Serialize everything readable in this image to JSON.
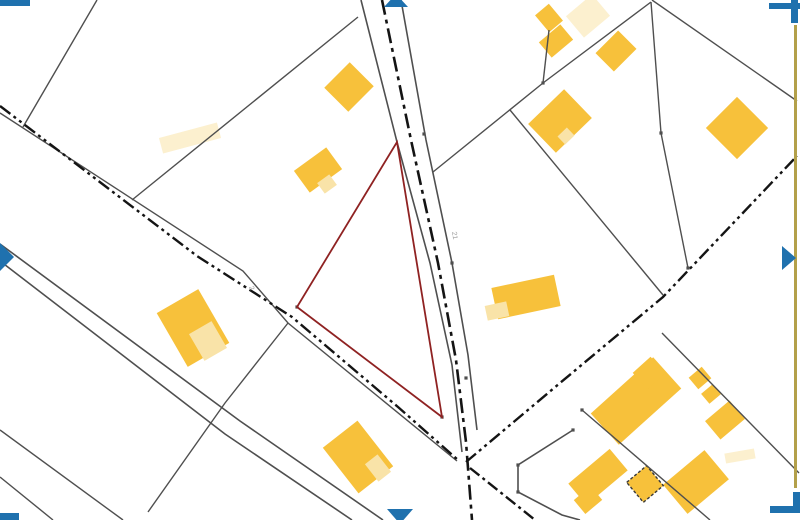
{
  "map": {
    "width": 800,
    "height": 520,
    "background": "#ffffff",
    "colors": {
      "building_solid": "#F7C13B",
      "building_light": "#F9E3A8",
      "building_ghost": "#FCF0CF",
      "parcel_line": "#4f4f4f",
      "road_axis": "#141414",
      "highlight": "#8f2222",
      "frame_blue": "#1f71ae",
      "sheet_edge": "#b3a04a",
      "label_gray": "#999999"
    },
    "sheet_edge_line": {
      "x": 795.5,
      "y1": 25,
      "y2": 488,
      "width": 3
    },
    "frame_corners": [
      {
        "name": "top-left-bracket",
        "rects": [
          [
            0,
            0,
            30,
            6
          ]
        ]
      },
      {
        "name": "top-right-bracket",
        "rects": [
          [
            769,
            3,
            31,
            6
          ],
          [
            791,
            0,
            7,
            23
          ]
        ]
      },
      {
        "name": "bottom-right-bracket",
        "rects": [
          [
            770,
            506,
            30,
            7
          ],
          [
            793,
            492,
            7,
            21
          ]
        ]
      },
      {
        "name": "bottom-left-bracket",
        "rects": [
          [
            0,
            513,
            19,
            7
          ]
        ]
      }
    ],
    "frame_triangles": [
      {
        "name": "left-edge-mark",
        "points": "0,243 14,257 0,271"
      },
      {
        "name": "right-edge-mark",
        "points": "782,246 796,258 782,270"
      },
      {
        "name": "top-edge-mark",
        "points": "384,7 408,7 396,-6"
      },
      {
        "name": "bottom-edge-mark",
        "points": "387,509 413,509 400,524"
      }
    ],
    "road_edges": [
      {
        "points": "361,0 397,142 430,263 452,365 462,452"
      },
      {
        "points": "401,0 426,140 452,263 468,355 477,430"
      },
      {
        "points": "0,244 240,421 383,520"
      },
      {
        "points": "0,261 225,434 352,520"
      },
      {
        "points": "573,430 518,465 518,492 562,515 580,520"
      }
    ],
    "road_axes": [
      {
        "points": "382,0 411,140 438,263 456,360 466,442 468,468 472,520",
        "width": 2.6,
        "dash": "15 5 4 5"
      },
      {
        "points": "0,106 197,256 292,317 398,407 458,460",
        "width": 2.4,
        "dash": "13 4 3 4 3 4"
      },
      {
        "points": "466,462 560,383 663,297 797,156",
        "width": 2.4,
        "dash": "13 4 3 4 3 4"
      },
      {
        "points": "470,468 535,520",
        "width": 2.4,
        "dash": "12 4 3 4"
      }
    ],
    "parcel_lines": [
      {
        "points": "97,0 23,127"
      },
      {
        "points": "358,17 132,200"
      },
      {
        "points": "0,113 243,271 288,323 457,461"
      },
      {
        "points": "288,323 225,403 148,512"
      },
      {
        "points": "0,430 123,520"
      },
      {
        "points": "0,477 53,520"
      },
      {
        "points": "651,2 543,83 433,172"
      },
      {
        "points": "651,2 661,133 688,268"
      },
      {
        "points": "652,0 797,101"
      },
      {
        "points": "549,30 543,83"
      },
      {
        "points": "510,110 663,295"
      },
      {
        "points": "662,333 799,473"
      },
      {
        "points": "582,410 710,520"
      }
    ],
    "highlight_parcel": {
      "points": "397,142 442,417 297,307",
      "width": 1.8
    },
    "buildings": [
      {
        "cx": 349,
        "cy": 87,
        "w": 36,
        "h": 34,
        "rot": -45,
        "type": "solid"
      },
      {
        "cx": 318,
        "cy": 170,
        "w": 40,
        "h": 27,
        "rot": -36,
        "type": "solid"
      },
      {
        "cx": 327,
        "cy": 184,
        "w": 15,
        "h": 13,
        "rot": -36,
        "type": "light"
      },
      {
        "cx": 549,
        "cy": 18,
        "w": 18,
        "h": 22,
        "rot": -40,
        "type": "solid"
      },
      {
        "cx": 556,
        "cy": 41,
        "w": 28,
        "h": 20,
        "rot": -40,
        "type": "solid"
      },
      {
        "cx": 588,
        "cy": 16,
        "w": 34,
        "h": 28,
        "rot": -40,
        "type": "ghost"
      },
      {
        "cx": 616,
        "cy": 51,
        "w": 32,
        "h": 26,
        "rot": -45,
        "type": "solid"
      },
      {
        "cx": 560,
        "cy": 121,
        "w": 50,
        "h": 40,
        "rot": -44,
        "type": "solid"
      },
      {
        "cx": 566,
        "cy": 136,
        "w": 13,
        "h": 11,
        "rot": -44,
        "type": "light"
      },
      {
        "cx": 737,
        "cy": 128,
        "w": 44,
        "h": 44,
        "rot": -45,
        "type": "solid"
      },
      {
        "cx": 526,
        "cy": 297,
        "w": 64,
        "h": 32,
        "rot": -12,
        "type": "solid"
      },
      {
        "cx": 497,
        "cy": 311,
        "w": 22,
        "h": 15,
        "rot": -12,
        "type": "light"
      },
      {
        "cx": 193,
        "cy": 328,
        "w": 48,
        "h": 62,
        "rot": -30,
        "type": "solid"
      },
      {
        "cx": 208,
        "cy": 341,
        "w": 26,
        "h": 31,
        "rot": -30,
        "type": "light"
      },
      {
        "cx": 358,
        "cy": 457,
        "w": 44,
        "h": 58,
        "rot": -38,
        "type": "solid"
      },
      {
        "cx": 378,
        "cy": 468,
        "w": 16,
        "h": 22,
        "rot": -38,
        "type": "light"
      },
      {
        "cx": 636,
        "cy": 401,
        "w": 84,
        "h": 42,
        "rot": -42,
        "type": "solid"
      },
      {
        "cx": 649,
        "cy": 373,
        "w": 24,
        "h": 22,
        "rot": -42,
        "type": "solid"
      },
      {
        "cx": 700,
        "cy": 378,
        "w": 17,
        "h": 15,
        "rot": -40,
        "type": "solid"
      },
      {
        "cx": 711,
        "cy": 394,
        "w": 15,
        "h": 13,
        "rot": -40,
        "type": "solid"
      },
      {
        "cx": 725,
        "cy": 420,
        "w": 32,
        "h": 24,
        "rot": -40,
        "type": "solid"
      },
      {
        "cx": 598,
        "cy": 477,
        "w": 54,
        "h": 28,
        "rot": -40,
        "type": "solid"
      },
      {
        "cx": 588,
        "cy": 500,
        "w": 22,
        "h": 18,
        "rot": -40,
        "type": "solid"
      },
      {
        "cx": 696,
        "cy": 482,
        "w": 54,
        "h": 38,
        "rot": -40,
        "type": "solid"
      },
      {
        "cx": 645,
        "cy": 484,
        "w": 26,
        "h": 26,
        "rot": -40,
        "type": "dashed"
      },
      {
        "cx": 190,
        "cy": 138,
        "w": 60,
        "h": 16,
        "rot": -15,
        "type": "ghost"
      },
      {
        "cx": 740,
        "cy": 456,
        "w": 30,
        "h": 10,
        "rot": -10,
        "type": "ghost"
      }
    ],
    "vertex_ticks": [
      [
        424,
        134
      ],
      [
        452,
        263
      ],
      [
        466,
        378
      ],
      [
        518,
        465
      ],
      [
        518,
        492
      ],
      [
        573,
        430
      ],
      [
        442,
        417
      ],
      [
        297,
        307
      ],
      [
        661,
        133
      ],
      [
        543,
        83
      ],
      [
        688,
        268
      ],
      [
        582,
        410
      ]
    ],
    "labels": [
      {
        "text": "21",
        "x": 452,
        "y": 232,
        "rot": 80,
        "size": 7
      },
      {
        "text": "2",
        "x": 249,
        "y": 287,
        "rot": 70,
        "size": 7
      }
    ]
  }
}
